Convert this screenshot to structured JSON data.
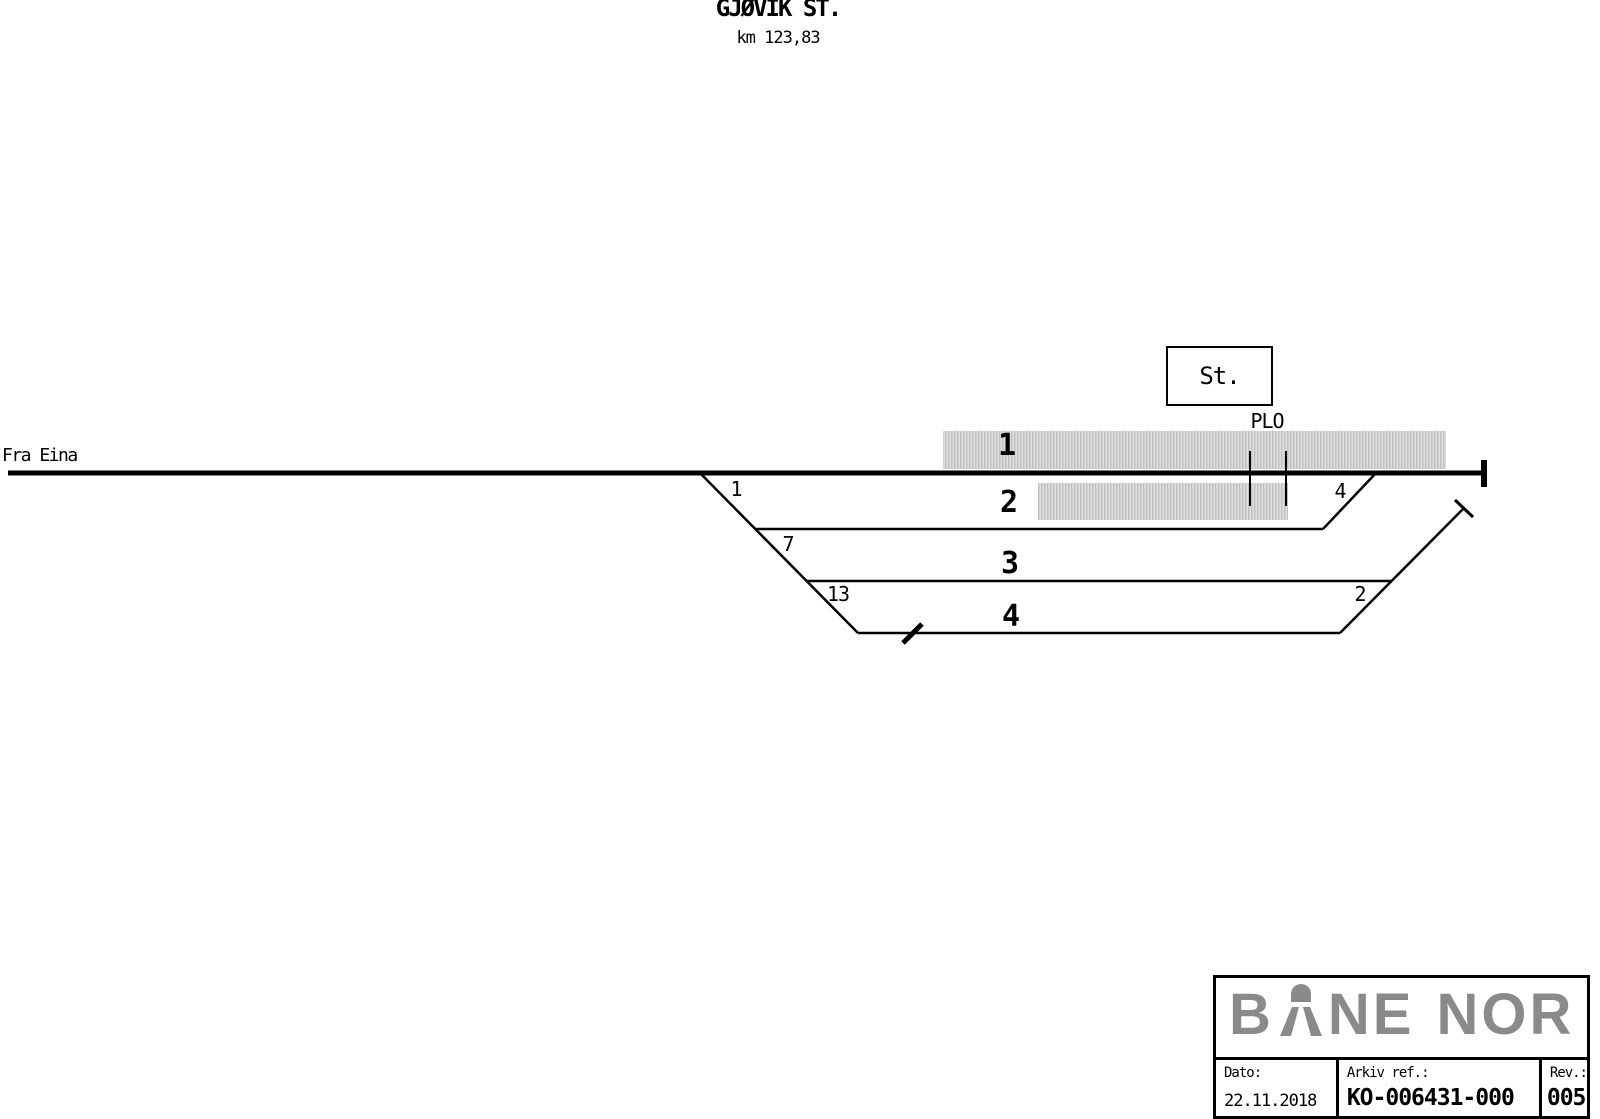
{
  "header": {
    "title": "GJØVIK ST.",
    "subtitle": "km 123,83"
  },
  "diagram": {
    "from_label": "Fra Eina",
    "station_box_label": "St.",
    "level_crossing_label": "PLO",
    "track_labels": [
      "1",
      "2",
      "3",
      "4"
    ],
    "switch_labels": [
      "1",
      "7",
      "13",
      "4",
      "2"
    ],
    "colors": {
      "line": "#000000",
      "platform": "#cdcdcd"
    }
  },
  "title_block": {
    "logo": {
      "name": "BANE NOR",
      "part1": "B",
      "part2": "NE",
      "part3": "NOR",
      "color": "#8a8a8a"
    },
    "fields": [
      {
        "label": "Dato:",
        "value": "22.11.2018"
      },
      {
        "label": "Arkiv ref.:",
        "value": "KO-006431-000"
      },
      {
        "label": "Rev.:",
        "value": "005"
      }
    ]
  }
}
